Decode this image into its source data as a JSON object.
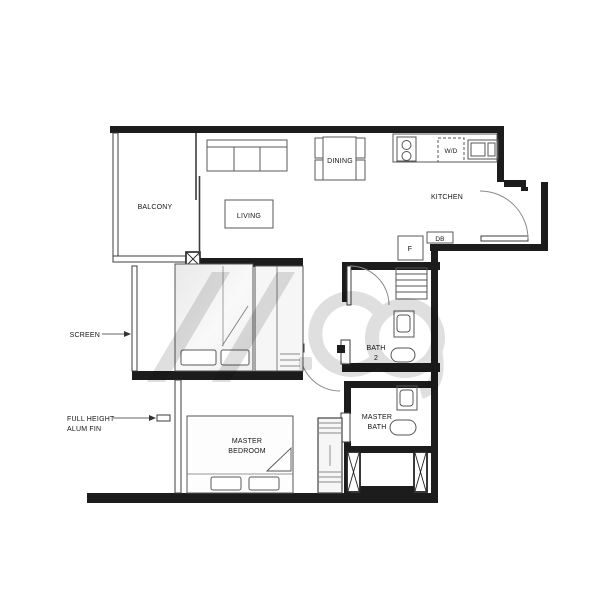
{
  "document": {
    "type": "apartment-floor-plan"
  },
  "labels": {
    "balcony": "BALCONY",
    "living": "LIVING",
    "dining": "DINING",
    "kitchen": "KITCHEN",
    "washer_dryer": "W/D",
    "fridge": "F",
    "distribution_board": "DB",
    "bath2_line1": "BATH",
    "bath2_line2": "2",
    "master_bath_line1": "MASTER",
    "master_bath_line2": "BATH",
    "master_bedroom_line1": "MASTER",
    "master_bedroom_line2": "BEDROOM",
    "screen": "SCREEN",
    "alum_fin_line1": "FULL HEIGHT",
    "alum_fin_line2": "ALUM FIN"
  },
  "colors": {
    "wall": "#1c1c1c",
    "line": "#4a4a4a",
    "furn": "#5a5a5a",
    "bg": "#ffffff",
    "watermark": "#c0c0c0",
    "text": "#151515"
  }
}
